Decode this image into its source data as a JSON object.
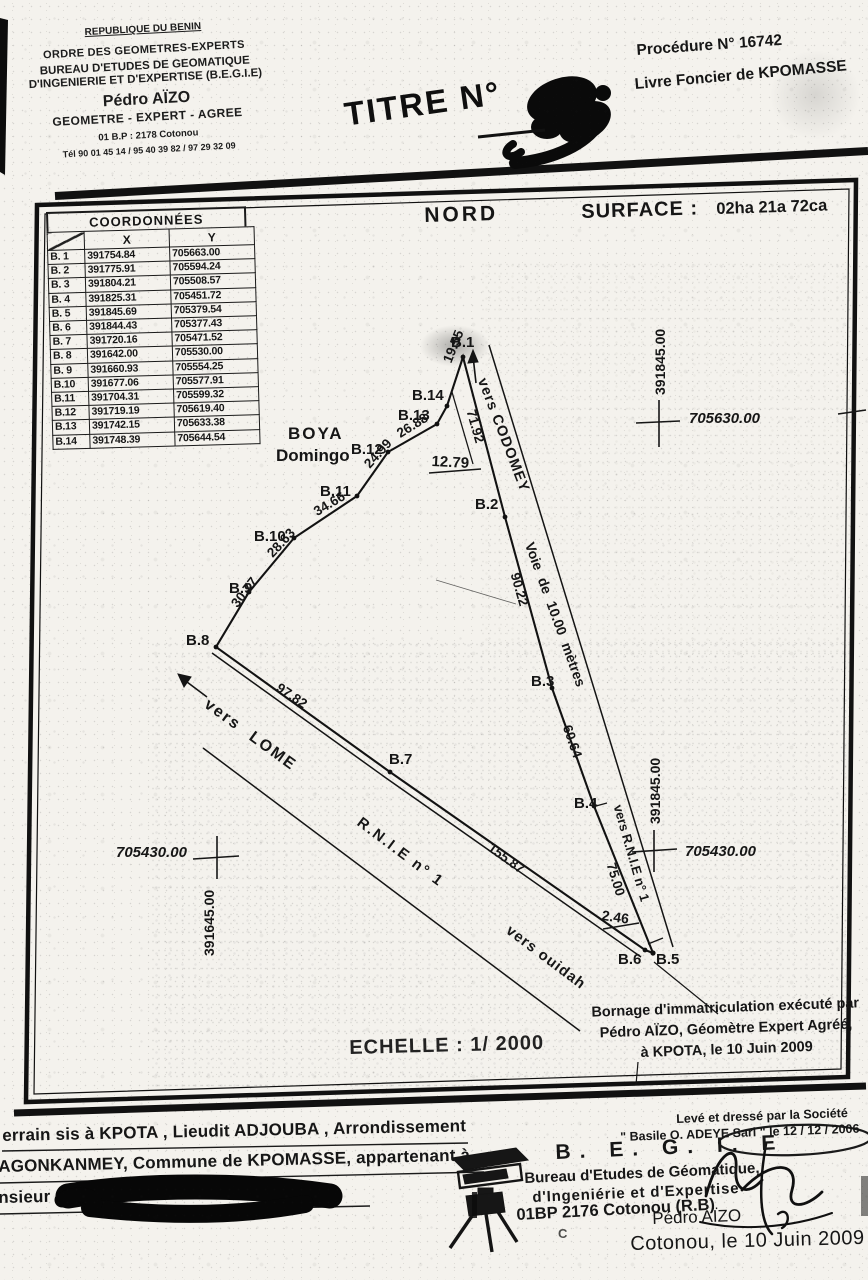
{
  "header": {
    "stamp": {
      "country": "REPUBLIQUE DU BENIN",
      "order": "ORDRE DES GEOMETRES-EXPERTS",
      "bureau1": "BUREAU D'ETUDES DE GEOMATIQUE",
      "bureau2": "D'INGENIERIE ET D'EXPERTISE (B.E.G.I.E)",
      "name": "Pédro AÏZO",
      "title": "GEOMETRE - EXPERT - AGREE",
      "address": "01 B.P : 2178 Cotonou",
      "phone": "Tél 90 01 45 14 / 95 40 39 82 / 97 29 32 09"
    },
    "titre_label": "TITRE N°",
    "procedure": "Procédure N°  16742",
    "livre": "Livre Foncier de KPOMASSE"
  },
  "map": {
    "nord": "NORD",
    "surface_label": "SURFACE :",
    "surface_value": "02ha 21a 72ca",
    "table": {
      "title": "COORDONNÉES",
      "col_x": "X",
      "col_y": "Y",
      "rows": [
        {
          "id": "B. 1",
          "x": "391754.84",
          "y": "705663.00"
        },
        {
          "id": "B. 2",
          "x": "391775.91",
          "y": "705594.24"
        },
        {
          "id": "B. 3",
          "x": "391804.21",
          "y": "705508.57"
        },
        {
          "id": "B. 4",
          "x": "391825.31",
          "y": "705451.72"
        },
        {
          "id": "B. 5",
          "x": "391845.69",
          "y": "705379.54"
        },
        {
          "id": "B. 6",
          "x": "391844.43",
          "y": "705377.43"
        },
        {
          "id": "B. 7",
          "x": "391720.16",
          "y": "705471.52"
        },
        {
          "id": "B. 8",
          "x": "391642.00",
          "y": "705530.00"
        },
        {
          "id": "B. 9",
          "x": "391660.93",
          "y": "705554.25"
        },
        {
          "id": "B.10",
          "x": "391677.06",
          "y": "705577.91"
        },
        {
          "id": "B.11",
          "x": "391704.31",
          "y": "705599.32"
        },
        {
          "id": "B.12",
          "x": "391719.19",
          "y": "705619.40"
        },
        {
          "id": "B.13",
          "x": "391742.15",
          "y": "705633.38"
        },
        {
          "id": "B.14",
          "x": "391748.39",
          "y": "705644.54"
        }
      ]
    },
    "locality": {
      "line1": "BOYA",
      "line2": "Domingo"
    },
    "points": {
      "b1": "B.1",
      "b2": "B.2",
      "b3": "B.3",
      "b4": "B.4",
      "b5": "B.5",
      "b6": "B.6",
      "b7": "B.7",
      "b8": "B.8",
      "b9": "B.9",
      "b10": "B.10",
      "b11": "B.11",
      "b12": "B.12",
      "b13": "B.13",
      "b14": "B.14"
    },
    "distances": {
      "b8_b9": "30.77",
      "b9_b10": "28.63",
      "b10_b11": "34.66",
      "b11_b12": "24.99",
      "b12_b13": "26.88",
      "b14_b1": "19.55",
      "b1_b2": "71.92",
      "tie_b2": "12.79",
      "b2_b3": "90.22",
      "b3_b4": "60.64",
      "b4_b5": "75.00",
      "b6_b5": "2.46",
      "b8_b7": "97.82",
      "b7_b6": "155.87"
    },
    "roads": {
      "codomey": "vers CODOMEY",
      "voie": "Voie de 10.00 mètres",
      "vers_rnie": "vers R.N.I.E n° 1",
      "rnie": "R.N.I.E n° 1",
      "ouidah": "vers ouidah",
      "lome": "vers LOME"
    },
    "grid": {
      "x_top": "391845.00",
      "y_top": "705630.00",
      "x_mid": "391845.00",
      "y_right": "705430.00",
      "y_left": "705430.00",
      "x_left": "391645.00"
    },
    "echelle": "ECHELLE : 1/ 2000",
    "bornage": {
      "line1": "Bornage d'immatriculation exécuté par",
      "line2": "Pédro AÏZO, Géomètre Expert Agréé,",
      "line3": "à KPOTA, le 10 Juin 2009"
    }
  },
  "footer": {
    "left": {
      "line1": "errain sis à KPOTA , Lieudit ADJOUBA , Arrondissement",
      "line2": "AGONKANMEY, Commune de KPOMASSE, appartenant à",
      "line3": "nsieur"
    },
    "right": {
      "leve1": "Levé et dressé par la Société",
      "leve2": "\" Basile O. ADEYE  Sarl \" le 12 / 12 / 2006",
      "begie": "B. E. G. I. E",
      "bureau1": "Bureau d'Etudes de Géomatique,",
      "bureau2": "d'Ingeniérie et d'Expertise",
      "address": "01BP  2176 Cotonou (R.B)",
      "fragment": "C",
      "signer": "Pédro AÏZO",
      "date": "Cotonou, le 10 Juin  2009"
    }
  },
  "colors": {
    "ink": "#161616",
    "paper": "#f4f2ed"
  }
}
